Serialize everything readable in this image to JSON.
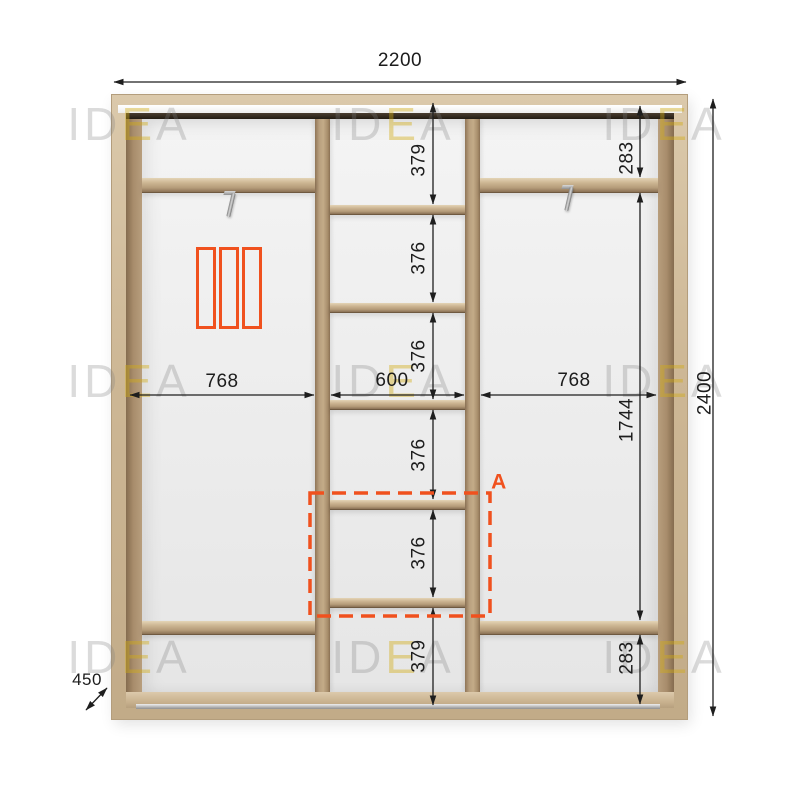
{
  "drawing": {
    "type": "wardrobe-interior-elevation",
    "detail_label": "A"
  },
  "watermark": {
    "part1": "ID",
    "part2": "E",
    "part3": "A"
  },
  "dims": {
    "total_width": "2200",
    "total_height": "2400",
    "depth": "450",
    "sections": {
      "left": "768",
      "middle": "600",
      "right": "768"
    },
    "middle_column": [
      "379",
      "376",
      "376",
      "376",
      "376",
      "379"
    ],
    "right_column": [
      "283",
      "1744",
      "283"
    ]
  },
  "icons": {
    "door_icon": "sliding-door-3-panel-icon",
    "hanger_icon": "pull-out-hanger-bracket-icon"
  },
  "colors": {
    "accent": "#F0511E",
    "dimension_line": "#1E1E1E",
    "wood_light": "#CDB795",
    "wood_dark": "#A78C6B",
    "interior": "#EFEFEF"
  }
}
